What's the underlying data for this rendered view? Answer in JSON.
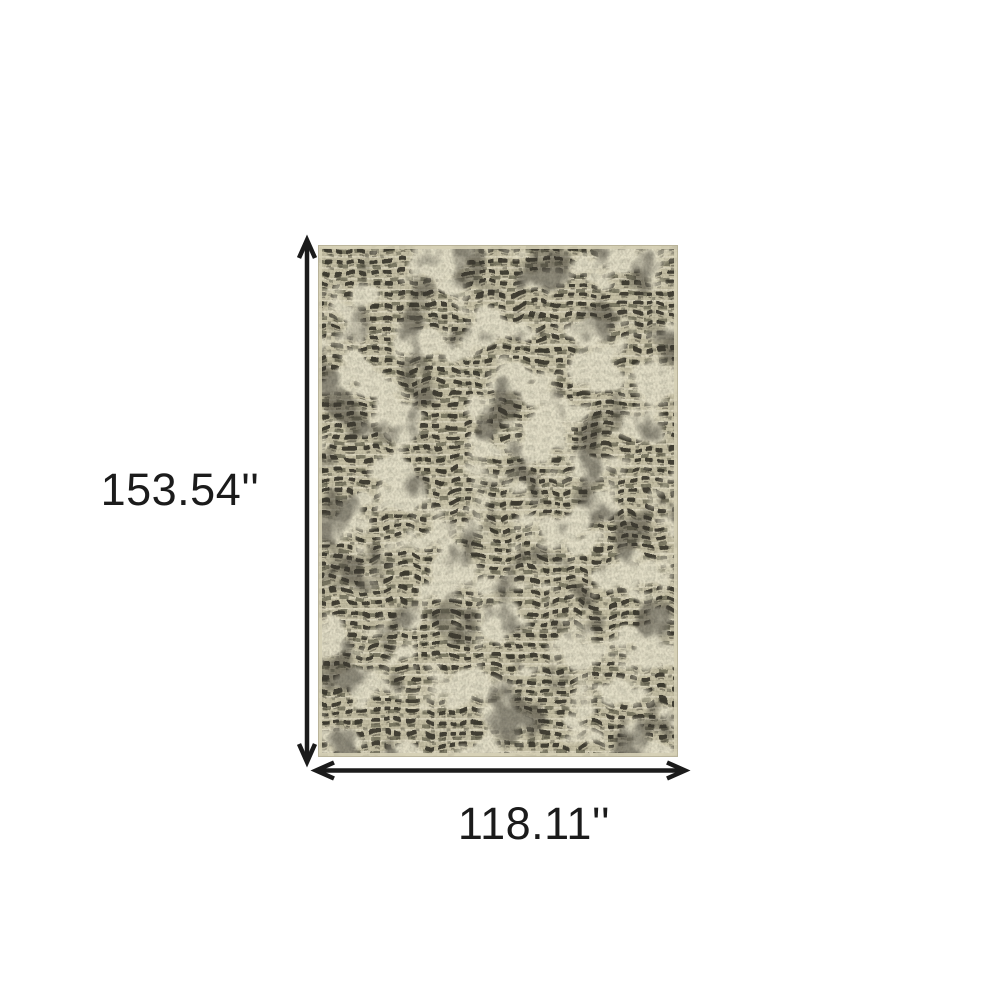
{
  "page": {
    "background_color": "#ffffff",
    "type_label": "rug dimension diagram"
  },
  "diagram": {
    "height_label": "153.54''",
    "width_label": "118.11''",
    "arrow_color": "#1b1b1b",
    "label_color": "#1b1b1b"
  },
  "rug": {
    "description": "beige and charcoal abstract tweed area rug",
    "base_color": "#c7c1a6",
    "dash_dark_color": "#37352b",
    "dash_mid_color": "#6e6b58",
    "cream_color": "#e8e3cc",
    "row_shadow_color": "#a9a48a",
    "selvage_color": "#d6d0b6",
    "edge_line_color": "#b3ad93"
  }
}
